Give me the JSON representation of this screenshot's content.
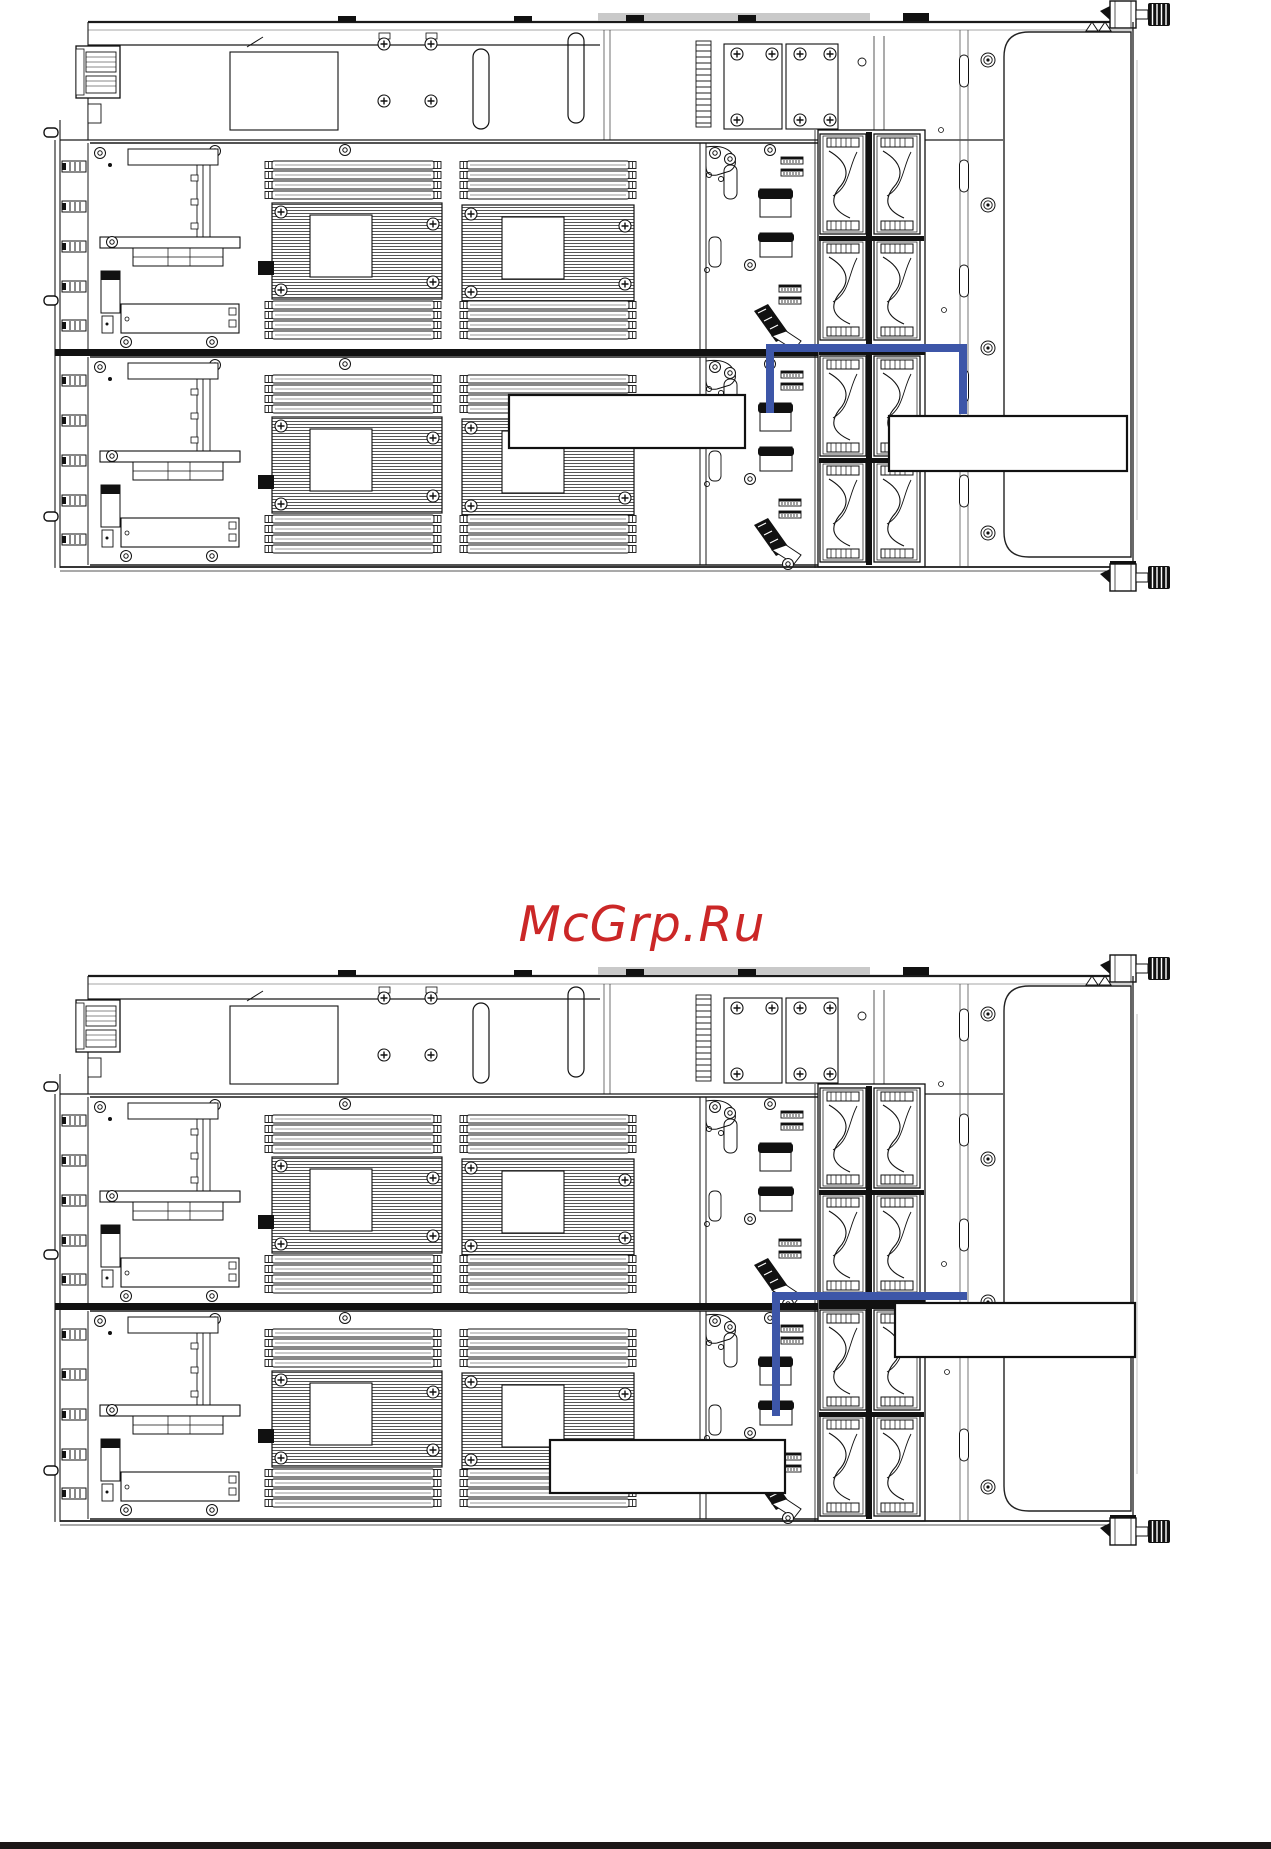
{
  "page": {
    "background": "#ffffff",
    "footer_bar_color": "#1c1717"
  },
  "watermark": {
    "text": "McGrp.Ru",
    "color": "#cb2727"
  },
  "figures": [
    {
      "name": "server-chassis-cable-routing-figure-1",
      "cable_color": "#3d56a8",
      "callouts": [
        {
          "text": ""
        },
        {
          "text": ""
        }
      ]
    },
    {
      "name": "server-chassis-cable-routing-figure-2",
      "cable_color": "#3d56a8",
      "callouts": [
        {
          "text": ""
        },
        {
          "text": ""
        }
      ]
    }
  ]
}
